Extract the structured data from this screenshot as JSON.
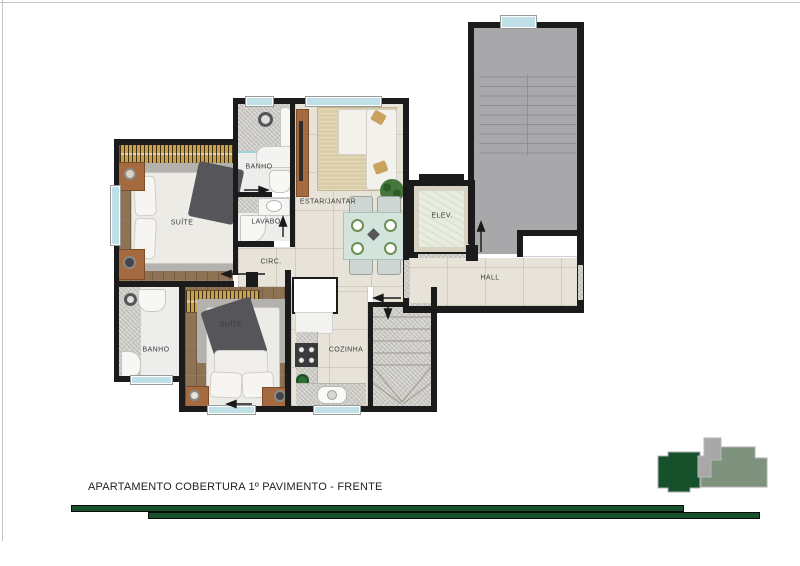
{
  "rooms": {
    "suite1": {
      "label": "SUÍTE"
    },
    "banho1": {
      "label": "BANHO"
    },
    "lavabo": {
      "label": "LAVABO"
    },
    "circ": {
      "label": "CIRC."
    },
    "estar": {
      "label": "ESTAR/JANTAR"
    },
    "elev": {
      "label": "ELEV."
    },
    "hall": {
      "label": "HALL"
    },
    "suite2": {
      "label": "SUÍTE"
    },
    "banho2": {
      "label": "BANHO"
    },
    "cozinha": {
      "label": "COZINHA"
    }
  },
  "footer": {
    "caption": "APARTAMENTO COBERTURA 1º PAVIMENTO - FRENTE"
  },
  "colors": {
    "brand_green": "#17512b",
    "logo_gray_green": "#7f927e",
    "logo_gray": "#a8a8a8",
    "wall": "#1b1b1b",
    "wood": "#8d7254",
    "tile": "#e7e3d9",
    "granite": "#d9d8d3",
    "common_gray": "#a8a8aa",
    "window_aqua": "#bfe0e6",
    "closet_gold": "#c7a050"
  }
}
